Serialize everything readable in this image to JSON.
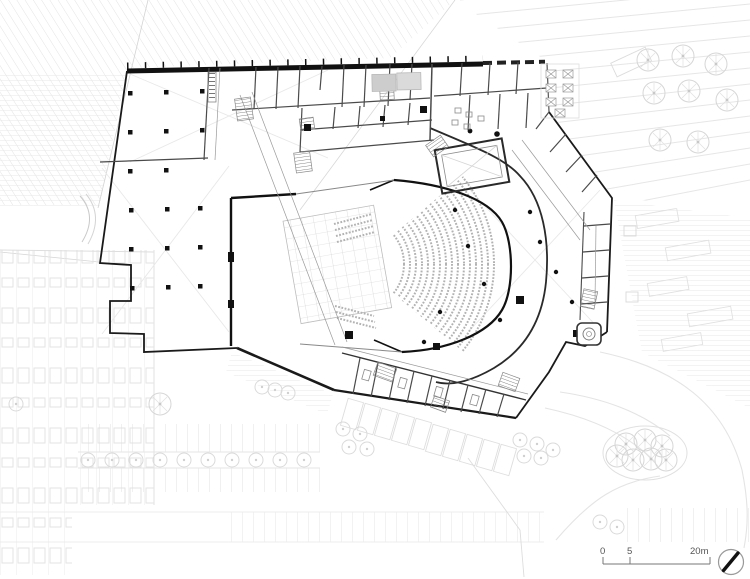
{
  "plan": {
    "kind": "architectural ground-floor site plan of a performing-arts building",
    "scale_bar": {
      "tick0": "0",
      "tick5": "5",
      "tick20": "20m"
    },
    "north_arrow": "compass needle pointing north-east",
    "palette": {
      "exterior_wall": "#1a1a1a",
      "interior_wall": "#4a4a4a",
      "minor_wall": "#9a9a9a",
      "landscape": "#e2e2e2",
      "seating_rows": "#b2b2b2",
      "background": "#ffffff"
    },
    "features": [
      "theater-auditorium-seating",
      "stage-fly-grid",
      "column-grid-hall",
      "roof-light-pool",
      "dressing-room-wing",
      "outdoor-terrace-seating",
      "parking-lot",
      "street-trees",
      "terraced-landscape",
      "drop-off-loop"
    ]
  }
}
